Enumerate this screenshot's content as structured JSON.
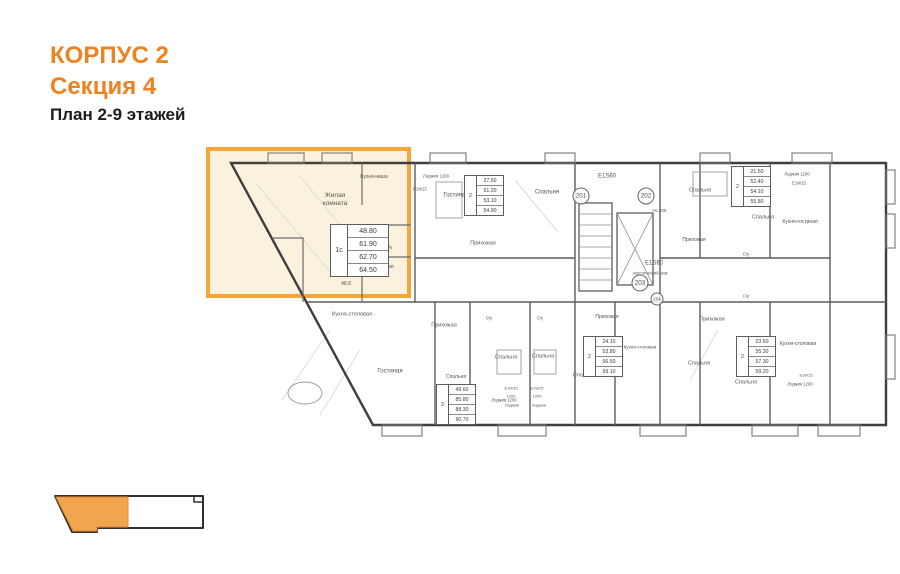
{
  "title": {
    "building": "КОРПУС 2",
    "section": "Секция 4",
    "plan_caption": "План 2-9 этажей"
  },
  "colors": {
    "accent_orange": "#EF8220",
    "highlight_border": "#F2A737",
    "highlight_fill": "#FAF2DD",
    "minimap_selected": "#F2A44F",
    "plan_line": "#3E3E3E"
  },
  "selected_apartment": {
    "type": "1с",
    "areas": [
      "48.80",
      "61.90",
      "62.70",
      "64.50"
    ]
  },
  "plan": {
    "area_tables": [
      {
        "type": "1с",
        "rows": [
          "48.80",
          "61.90",
          "62.70",
          "64.50"
        ],
        "x": 330,
        "y": 224,
        "large": true
      },
      {
        "type": "2",
        "rows": [
          "27.50",
          "51.20",
          "53.10",
          "54.90"
        ],
        "x": 464,
        "y": 175
      },
      {
        "type": "2",
        "rows": [
          "21.50",
          "52.40",
          "54.10",
          "55.80"
        ],
        "x": 731,
        "y": 166
      },
      {
        "type": "3",
        "rows": [
          "49.60",
          "85.80",
          "88.30",
          "90.70"
        ],
        "x": 436,
        "y": 384
      },
      {
        "type": "2",
        "rows": [
          "24.10",
          "53.80",
          "56.50",
          "59.10"
        ],
        "x": 583,
        "y": 336
      },
      {
        "type": "2",
        "rows": [
          "23.60",
          "55.30",
          "57.30",
          "59.20"
        ],
        "x": 736,
        "y": 336
      }
    ],
    "unit_numbers": [
      {
        "label": "201",
        "x": 581,
        "y": 196,
        "d": 15
      },
      {
        "label": "202",
        "x": 646,
        "y": 196,
        "d": 15
      },
      {
        "label": "203",
        "x": 640,
        "y": 283,
        "d": 15
      },
      {
        "label": "204",
        "x": 657,
        "y": 299,
        "d": 11
      }
    ],
    "labels": [
      {
        "text": "Жилая\nкомната",
        "x": 335,
        "y": 200,
        "fs": 6.5
      },
      {
        "text": "Кухня-ниша",
        "x": 374,
        "y": 177,
        "fs": 5
      },
      {
        "text": "С/у",
        "x": 389,
        "y": 247,
        "fs": 4.5
      },
      {
        "text": "Прихожая",
        "x": 382,
        "y": 267,
        "fs": 5
      },
      {
        "text": "3.6",
        "x": 382,
        "y": 275,
        "fs": 4.5
      },
      {
        "text": "48.8",
        "x": 346,
        "y": 284,
        "fs": 5
      },
      {
        "text": "Лоджия 1200",
        "x": 436,
        "y": 176,
        "fs": 4.3
      },
      {
        "text": "Е1W15",
        "x": 420,
        "y": 189,
        "fs": 4.2
      },
      {
        "text": "Гостиная",
        "x": 456,
        "y": 196,
        "fs": 6
      },
      {
        "text": "Спальня",
        "x": 547,
        "y": 193,
        "fs": 6
      },
      {
        "text": "Прихожая",
        "x": 483,
        "y": 244,
        "fs": 5.5
      },
      {
        "text": "Е1S60",
        "x": 607,
        "y": 177,
        "fs": 6
      },
      {
        "text": "+6.200",
        "x": 659,
        "y": 212,
        "fs": 4.8
      },
      {
        "text": "Е1S60",
        "x": 654,
        "y": 264,
        "fs": 6
      },
      {
        "text": "Акустический шов",
        "x": 650,
        "y": 273,
        "fs": 4.2
      },
      {
        "text": "Спальня",
        "x": 700,
        "y": 191,
        "fs": 5.5
      },
      {
        "text": "Спальня",
        "x": 763,
        "y": 218,
        "fs": 5.5
      },
      {
        "text": "Прихожая",
        "x": 694,
        "y": 240,
        "fs": 5
      },
      {
        "text": "Кухня-гостиная",
        "x": 800,
        "y": 222,
        "fs": 5
      },
      {
        "text": "Лоджия 1200",
        "x": 797,
        "y": 174,
        "fs": 4.2
      },
      {
        "text": "Е1W15",
        "x": 799,
        "y": 183,
        "fs": 4.2
      },
      {
        "text": "С/у",
        "x": 746,
        "y": 254,
        "fs": 4.2
      },
      {
        "text": "С/у",
        "x": 746,
        "y": 296,
        "fs": 4.2
      },
      {
        "text": "Кухня-столовая",
        "x": 352,
        "y": 315,
        "fs": 5.5
      },
      {
        "text": "Гостиная",
        "x": 390,
        "y": 372,
        "fs": 6
      },
      {
        "text": "Прихожая",
        "x": 444,
        "y": 326,
        "fs": 5.5
      },
      {
        "text": "Спальня",
        "x": 456,
        "y": 377,
        "fs": 5
      },
      {
        "text": "Лоджия 1200",
        "x": 504,
        "y": 400,
        "fs": 4.2
      },
      {
        "text": "С/у",
        "x": 489,
        "y": 318,
        "fs": 4.2
      },
      {
        "text": "С/у",
        "x": 540,
        "y": 318,
        "fs": 4.2
      },
      {
        "text": "Спальня",
        "x": 506,
        "y": 358,
        "fs": 5.5
      },
      {
        "text": "Спальня",
        "x": 543,
        "y": 357,
        "fs": 5.5
      },
      {
        "text": "Е1W15",
        "x": 511,
        "y": 389,
        "fs": 4
      },
      {
        "text": "Е1W15",
        "x": 537,
        "y": 389,
        "fs": 4
      },
      {
        "text": "1200",
        "x": 511,
        "y": 397,
        "fs": 4
      },
      {
        "text": "1200",
        "x": 537,
        "y": 397,
        "fs": 4
      },
      {
        "text": "Лоджия",
        "x": 512,
        "y": 406,
        "fs": 4
      },
      {
        "text": "Лоджия",
        "x": 539,
        "y": 406,
        "fs": 4
      },
      {
        "text": "Прихожая",
        "x": 607,
        "y": 317,
        "fs": 5
      },
      {
        "text": "Спальня",
        "x": 584,
        "y": 376,
        "fs": 5.5
      },
      {
        "text": "Кухня-столовая",
        "x": 640,
        "y": 347,
        "fs": 4.5
      },
      {
        "text": "Прихожая",
        "x": 712,
        "y": 320,
        "fs": 5.5
      },
      {
        "text": "Спальня",
        "x": 699,
        "y": 364,
        "fs": 5.5
      },
      {
        "text": "Спальня",
        "x": 746,
        "y": 383,
        "fs": 5.5
      },
      {
        "text": "Кухня-столовая",
        "x": 798,
        "y": 344,
        "fs": 5
      },
      {
        "text": "Лоджия 1200",
        "x": 800,
        "y": 384,
        "fs": 4.2
      },
      {
        "text": "Е1W15",
        "x": 806,
        "y": 376,
        "fs": 4
      }
    ]
  }
}
